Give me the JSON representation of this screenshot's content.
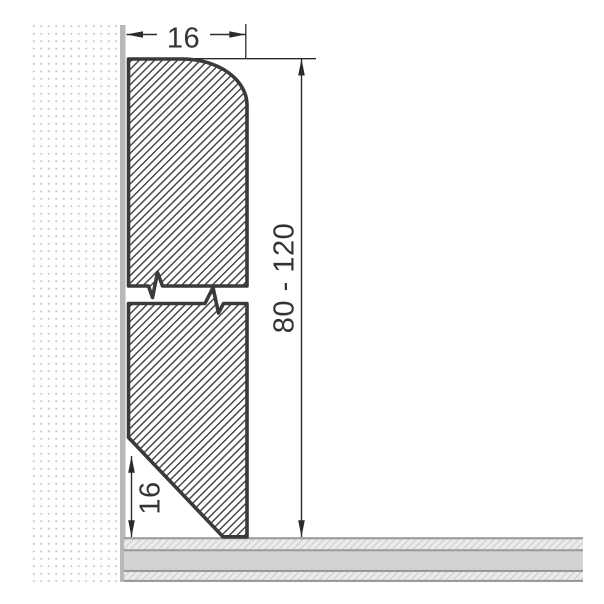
{
  "drawing": {
    "type": "technical-cross-section",
    "subject": "Skirting board profile mounted against wall above layered floor",
    "labels": {
      "width_top": "16",
      "height_range": "80 - 120",
      "bevel_height": "16"
    },
    "colors": {
      "background": "#ffffff",
      "profile_outline": "#3a3a3a",
      "profile_hatch": "#3f3f3f",
      "dimension": "#2b2b2b",
      "wall_dots": "#c9c9c9",
      "wall_edge": "#b8b8b8",
      "floor_core": "#d3d3d3",
      "floor_underlay": "#ebebeb",
      "floor_border": "#9a9a9a"
    }
  }
}
